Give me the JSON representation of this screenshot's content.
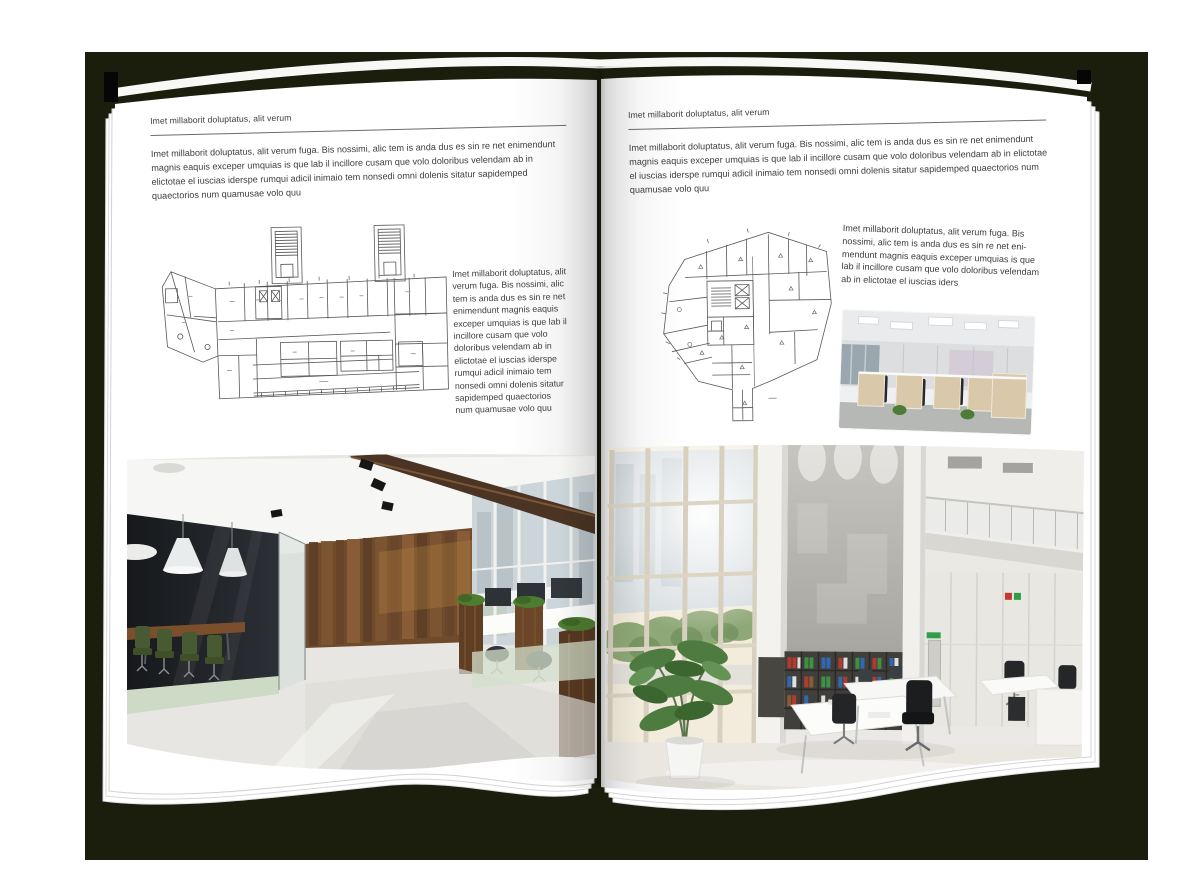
{
  "colors": {
    "backdrop": "#1c1e0d",
    "page": "#ffffff",
    "text": "#3d3d3d",
    "rule": "#6b6b6b"
  },
  "left_page": {
    "header": "Imet millaborit doluptatus, alit verum",
    "intro": "Imet millaborit doluptatus, alit verum fuga. Bis nossimi, alic tem is anda dus es sin re net enimendunt magnis eaquis exceper umquias is que lab il incillore cusam que volo doloribus velendam ab in elictotae el iuscias iderspe rumqui adicil inimaio tem nonsedi omni dolenis sitatur sapidemped quaectorios num quamusae volo quu",
    "side_text": "Imet millaborit doluptatus, alit verum fuga. Bis nossimi, alic tem is anda dus es sin re net enimendunt magnis eaquis exceper umquias is que lab il incillore cusam que volo doloribus velendam ab in elictotae el iuscias iderspe rumqui adicil inimaio tem nonsedi omni dolenis sitatur sapidemped quaectorios num quamusae volo quu"
  },
  "right_page": {
    "header": "Imet millaborit doluptatus, alit verum",
    "intro": "Imet millaborit doluptatus, alit verum fuga. Bis nossimi, alic tem is anda dus es sin re net enimendunt magnis eaquis exceper umquias is que lab il incillore cusam que volo doloribus velendam ab in elictotae el iuscias iderspe rumqui adicil inimaio tem nonsedi omni dolenis sitatur sapidemped quaectorios num quamusae volo quu",
    "side_text": "Imet millaborit doluptatus, alit verum fuga. Bis nossimi, alic tem is anda dus es sin re net eni-mendunt magnis eaquis exceper umquias is que lab il incillore cusam que volo doloribus velendam ab in elictotae el iuscias iders"
  }
}
